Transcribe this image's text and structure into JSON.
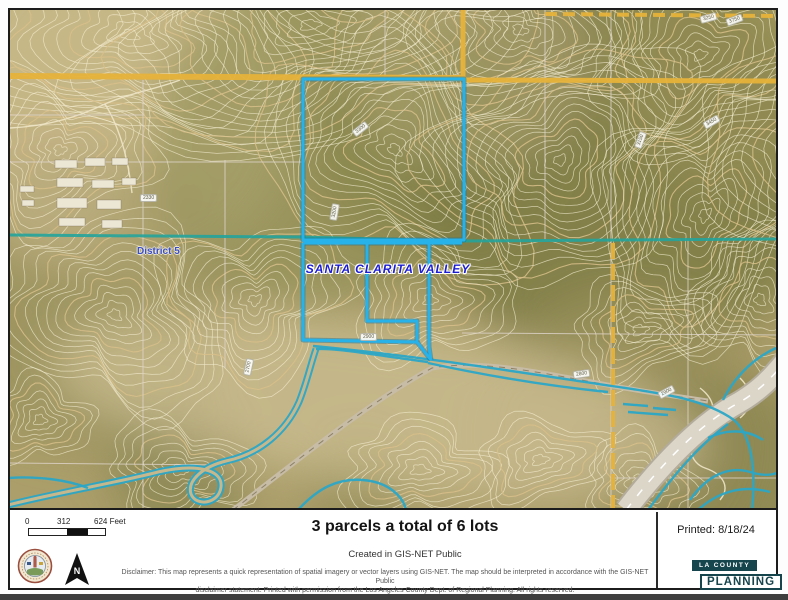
{
  "map": {
    "labels": {
      "valley": "SANTA CLARITA VALLEY",
      "district": "District 5"
    },
    "elevation_labels": [
      {
        "x": 342,
        "y": 115,
        "text": "3300",
        "rot": -38
      },
      {
        "x": 316,
        "y": 198,
        "text": "3200",
        "rot": -80
      },
      {
        "x": 350,
        "y": 323,
        "text": "2900",
        "rot": 0
      },
      {
        "x": 230,
        "y": 353,
        "text": "2700",
        "rot": -78
      },
      {
        "x": 130,
        "y": 184,
        "text": "2330",
        "rot": 0
      },
      {
        "x": 563,
        "y": 360,
        "text": "2800",
        "rot": -8
      },
      {
        "x": 648,
        "y": 378,
        "text": "2900",
        "rot": -28
      },
      {
        "x": 693,
        "y": 108,
        "text": "3450",
        "rot": -30
      },
      {
        "x": 690,
        "y": 4,
        "text": "3250",
        "rot": -15
      },
      {
        "x": 716,
        "y": 6,
        "text": "3750",
        "rot": -20
      },
      {
        "x": 622,
        "y": 126,
        "text": "3150",
        "rot": -70
      }
    ],
    "colors": {
      "parcel_outline": "#27b2ea",
      "parcel_casing": "#0c6f9e",
      "water": "#2ba6c6",
      "road_major": "#e6b23a",
      "district_boundary": "#23a39b",
      "contour": "#f3ecd0",
      "contour_index": "#d8c08a"
    }
  },
  "footer": {
    "scale": {
      "t0": "0",
      "t1": "312",
      "t2": "624 Feet"
    },
    "title": "3 parcels a total of 6 lots",
    "subtitle": "Created in GIS-NET Public",
    "printed": "Printed: 8/18/24",
    "disclaimer_line1": "Disclaimer: This map represents a quick representation of spatial imagery or vector layers using GIS-NET. The map should be interpreted in accordance with the GIS-NET Public",
    "disclaimer_line2": "disclaimer statement. Printed with permission from the Los Angeles County Dept. of Regional Planning. All rights reserved.",
    "logo": {
      "top": "LA COUNTY",
      "bottom": "PLANNING",
      "color": "#17454e"
    },
    "north_label": "N"
  }
}
